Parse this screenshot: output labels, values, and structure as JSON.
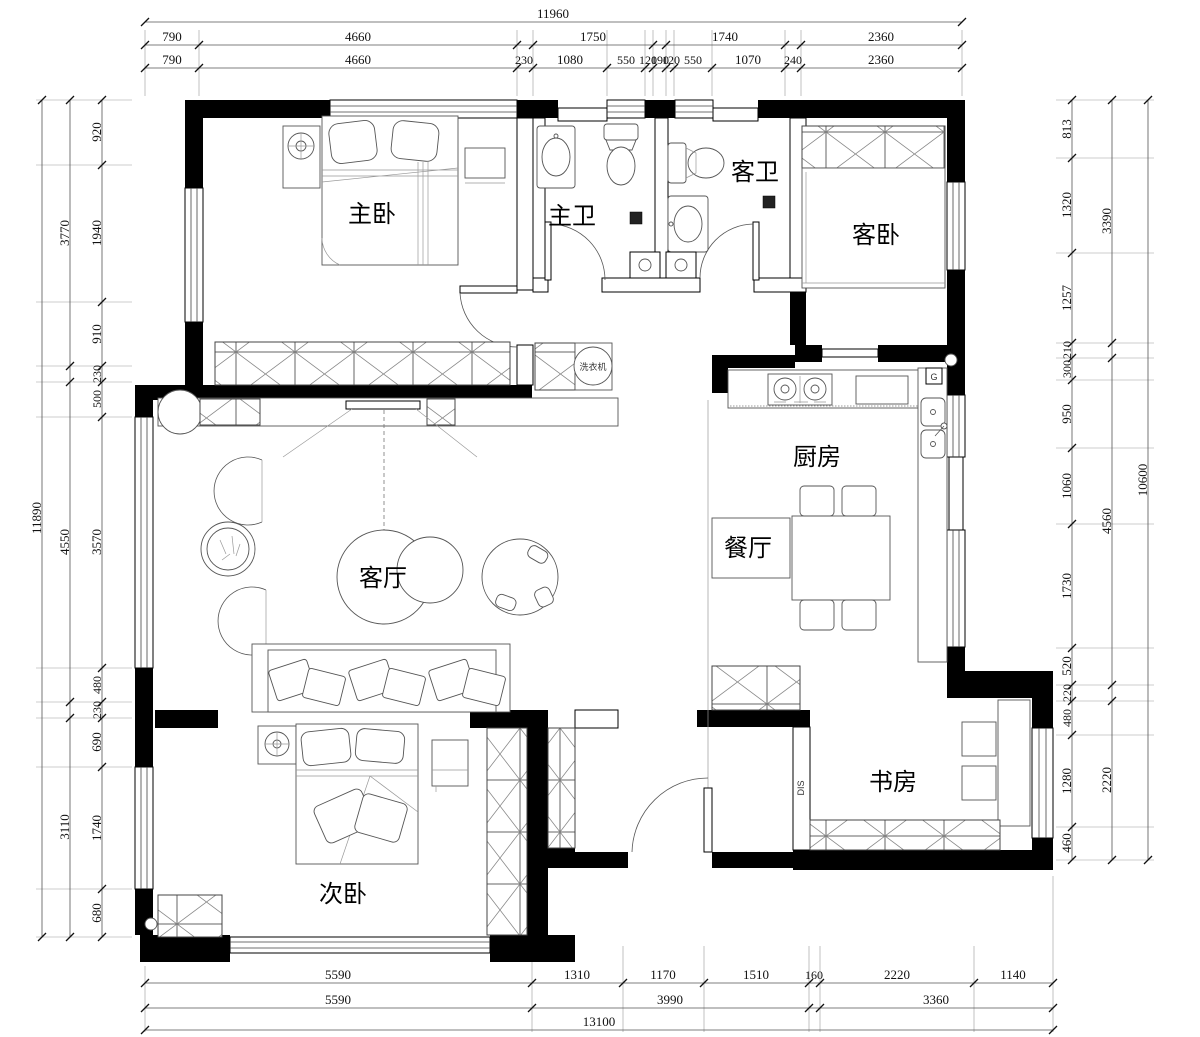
{
  "rooms": {
    "master_bedroom": "主卧",
    "master_bath": "主卫",
    "guest_bath": "客卫",
    "guest_bedroom": "客卧",
    "living_room": "客厅",
    "kitchen": "厨房",
    "dining_room": "餐厅",
    "second_bedroom": "次卧",
    "study": "书房"
  },
  "annotations": {
    "gas_meter": "G",
    "dis_box": "DIS",
    "washer": "洗衣机"
  },
  "dims": {
    "top": {
      "total": "11960",
      "row2": [
        "790",
        "4660",
        "1750",
        "1740",
        "2360"
      ],
      "row3": [
        "790",
        "4660",
        "230",
        "1080",
        "550",
        "120",
        "190",
        "120",
        "550",
        "1070",
        "240",
        "2360"
      ]
    },
    "bottom": {
      "row1": [
        "5590",
        "1310",
        "1170",
        "1510",
        "160",
        "2220",
        "1140"
      ],
      "row2": [
        "5590",
        "3990",
        "3360"
      ],
      "total": "13100"
    },
    "left": {
      "total": "11890",
      "mid": [
        "3770",
        "4550",
        "3110"
      ],
      "inner": [
        "920",
        "1940",
        "910",
        "230",
        "500",
        "3570",
        "480",
        "230",
        "690",
        "1740",
        "680"
      ]
    },
    "right": {
      "total": "10600",
      "mid": [
        "3390",
        "4560",
        "2220"
      ],
      "inner": [
        "813",
        "1320",
        "1257",
        "210",
        "300",
        "950",
        "1060",
        "1730",
        "520",
        "220",
        "480",
        "1280",
        "460"
      ]
    }
  }
}
